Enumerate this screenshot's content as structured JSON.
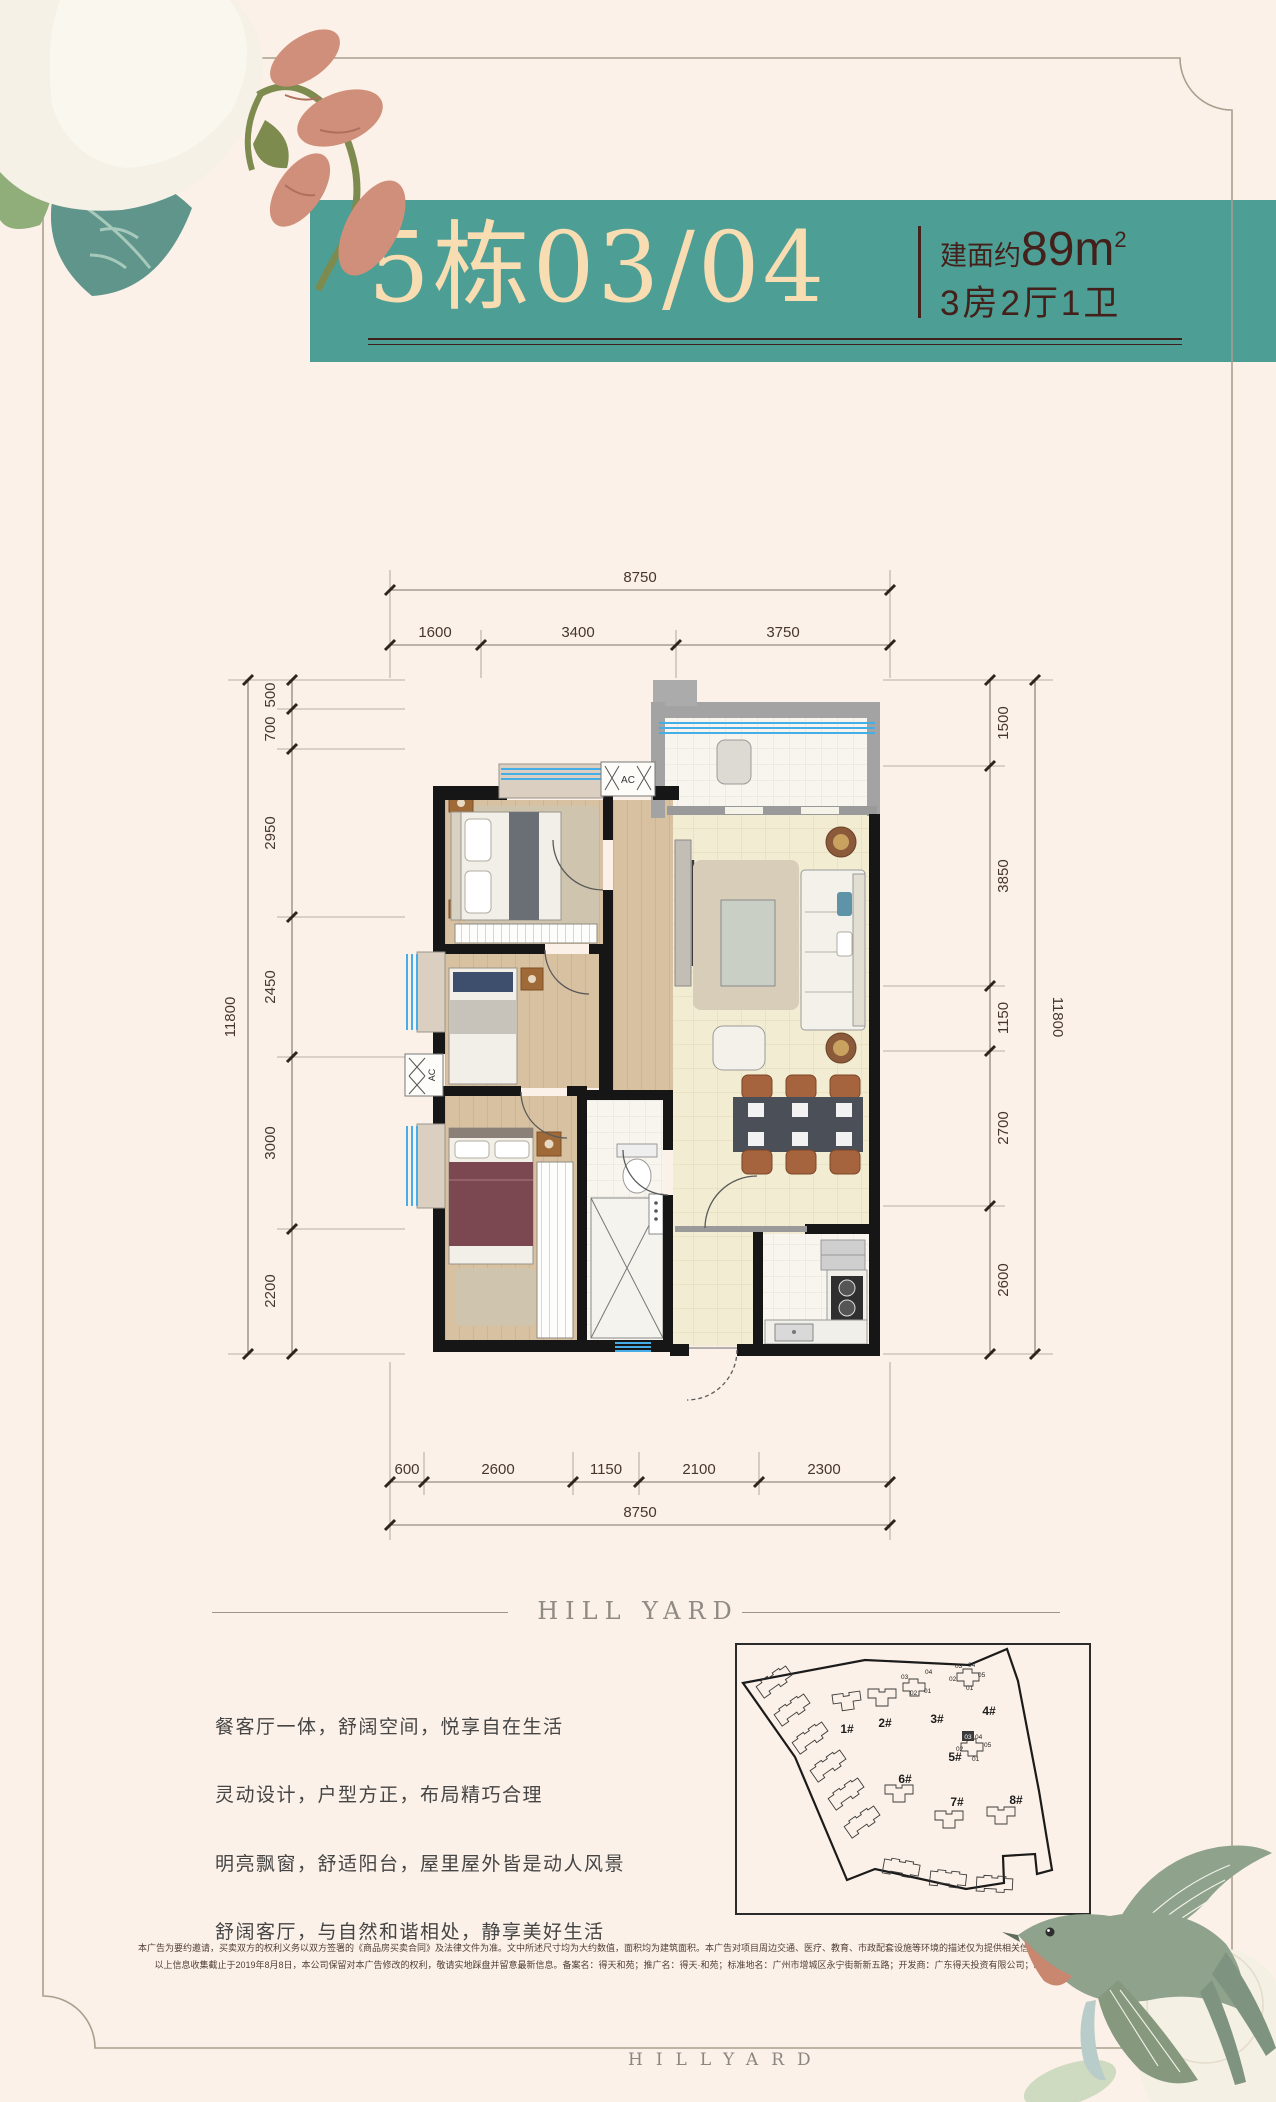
{
  "banner": {
    "title": "5栋03/04",
    "area_prefix": "建面约",
    "area_num": "89",
    "area_unit": "m",
    "area_sup": "2",
    "layout": "3房2厅1卫"
  },
  "floorplan": {
    "ac_label": "AC",
    "dims": {
      "top_total": "8750",
      "top_segments": [
        "1600",
        "3400",
        "3750"
      ],
      "bottom_segments": [
        "600",
        "2600",
        "1150",
        "2100",
        "2300"
      ],
      "bottom_total": "8750",
      "left_total": "11800",
      "left_segments": [
        "500",
        "700",
        "2950",
        "2450",
        "3000",
        "2200"
      ],
      "right_segments": [
        "1500",
        "3850",
        "1150",
        "2700",
        "2600"
      ],
      "right_total": "11800"
    }
  },
  "divider": {
    "brand": "HILL YARD"
  },
  "siteplan": {
    "buildings": [
      "1#",
      "2#",
      "3#",
      "4#",
      "5#",
      "6#",
      "7#",
      "8#"
    ],
    "cluster3_units": [
      "03",
      "04",
      "02",
      "01"
    ],
    "cluster4_units": [
      "03",
      "04",
      "02",
      "05",
      "01"
    ],
    "cluster5_highlight": "03",
    "cluster5_units": [
      "04",
      "02",
      "05",
      "01"
    ]
  },
  "marketing": {
    "line1": "餐客厅一体，舒阔空间，悦享自在生活",
    "line2": "灵动设计，户型方正，布局精巧合理",
    "line3": "明亮飘窗，舒适阳台，屋里屋外皆是动人风景",
    "line4": "舒阔客厅，与自然和谐相处，静享美好生活"
  },
  "legal": {
    "line1": "本广告为要约邀请，买卖双方的权利义务以双方签署的《商品房买卖合同》及法律文件为准。文中所述尺寸均为大约数值，面积均为建筑面积。本广告对项目周边交通、医疗、教育、市政配套设施等环境的描述仅为提供相关信息，不意味着本公司对此作出承诺。",
    "line2": "以上信息收集截止于2019年8月8日，本公司保留对本广告修改的权利，敬请实地踩盘并留意最新信息。备案名：得天和苑；推广名：得天·和苑；标准地名：广州市增城区永宁街新新五路；开发商：广东得天投资有限公司；制作时间：2019年8月"
  },
  "footer": {
    "brand": "HILLYARD"
  },
  "colors": {
    "banner_teal": "#4d9e95",
    "title_cream": "#f8ddb2",
    "maroon": "#44201a",
    "window_blue": "#45aee6"
  }
}
